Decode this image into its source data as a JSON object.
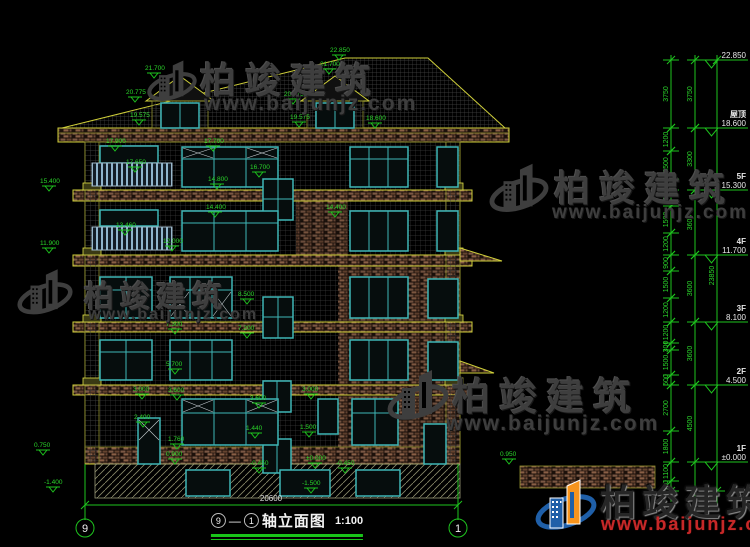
{
  "colors": {
    "cad_green": "#2ad42a",
    "cad_yellow": "#cfcf3a",
    "cad_teal": "#3fb6b6",
    "watermark_gray": "#3e3e3e",
    "logo_blue": "#1f5fa8",
    "logo_orange": "#f7941d",
    "url_red": "#c62828",
    "level_text": "#e8e8e8"
  },
  "watermark": {
    "brand": "柏竣建筑",
    "url": "www.baijunjz.com"
  },
  "footer_logo": {
    "brand": "柏竣建筑",
    "url": "www.baijunjz.com"
  },
  "title": {
    "left_bubble": "9",
    "separator": "—",
    "right_bubble": "1",
    "name": "轴立面图",
    "scale": "1:100"
  },
  "bottom": {
    "total_width": "20600",
    "left_bubble": "9",
    "right_bubble": "1"
  },
  "elevation_levels": [
    {
      "label": "",
      "value": "22.850",
      "y": 60
    },
    {
      "label": "屋顶",
      "value": "18.600",
      "y": 128
    },
    {
      "label": "5F",
      "value": "15.300",
      "y": 190
    },
    {
      "label": "4F",
      "value": "11.700",
      "y": 255
    },
    {
      "label": "3F",
      "value": "8.100",
      "y": 322
    },
    {
      "label": "2F",
      "value": "4.500",
      "y": 385
    },
    {
      "label": "1F",
      "value": "±0.000",
      "y": 462
    }
  ],
  "dim_columns": [
    {
      "x": 671,
      "segments": [
        {
          "v": "3750",
          "y1": 60,
          "y2": 128
        },
        {
          "v": "1200",
          "y1": 128,
          "y2": 151
        },
        {
          "v": "1500",
          "y1": 151,
          "y2": 179
        },
        {
          "v": "600",
          "y1": 179,
          "y2": 190
        },
        {
          "v": "900",
          "y1": 190,
          "y2": 206
        },
        {
          "v": "1500",
          "y1": 206,
          "y2": 233
        },
        {
          "v": "1200",
          "y1": 233,
          "y2": 255
        },
        {
          "v": "900",
          "y1": 255,
          "y2": 271
        },
        {
          "v": "1500",
          "y1": 271,
          "y2": 298
        },
        {
          "v": "1200",
          "y1": 298,
          "y2": 322
        },
        {
          "v": "1200",
          "y1": 322,
          "y2": 343
        },
        {
          "v": "300",
          "y1": 343,
          "y2": 350
        },
        {
          "v": "1500",
          "y1": 350,
          "y2": 375
        },
        {
          "v": "600",
          "y1": 375,
          "y2": 385
        },
        {
          "v": "2700",
          "y1": 385,
          "y2": 431
        },
        {
          "v": "1800",
          "y1": 431,
          "y2": 462
        },
        {
          "v": "1100",
          "y1": 462,
          "y2": 481
        },
        {
          "v": "600",
          "y1": 481,
          "y2": 491
        }
      ]
    },
    {
      "x": 695,
      "segments": [
        {
          "v": "3750",
          "y1": 60,
          "y2": 128
        },
        {
          "v": "3300",
          "y1": 128,
          "y2": 190
        },
        {
          "v": "3600",
          "y1": 190,
          "y2": 255
        },
        {
          "v": "3600",
          "y1": 255,
          "y2": 322
        },
        {
          "v": "3600",
          "y1": 322,
          "y2": 385
        },
        {
          "v": "4500",
          "y1": 385,
          "y2": 462
        }
      ]
    },
    {
      "x": 717,
      "segments": [
        {
          "v": "23850",
          "y1": 60,
          "y2": 491
        }
      ]
    }
  ],
  "annotations": [
    {
      "t": "22.850",
      "x": 330,
      "y": 52
    },
    {
      "t": "21.700",
      "x": 145,
      "y": 70
    },
    {
      "t": "20.775",
      "x": 126,
      "y": 94
    },
    {
      "t": "19.575",
      "x": 130,
      "y": 117
    },
    {
      "t": "21.700",
      "x": 320,
      "y": 66
    },
    {
      "t": "20.775",
      "x": 284,
      "y": 96
    },
    {
      "t": "19.575",
      "x": 290,
      "y": 119
    },
    {
      "t": "18.600",
      "x": 366,
      "y": 120
    },
    {
      "t": "17.900",
      "x": 106,
      "y": 143
    },
    {
      "t": "17.700",
      "x": 204,
      "y": 143
    },
    {
      "t": "17.650",
      "x": 126,
      "y": 164
    },
    {
      "t": "16.700",
      "x": 250,
      "y": 169
    },
    {
      "t": "15.400",
      "x": 40,
      "y": 183
    },
    {
      "t": "14.800",
      "x": 208,
      "y": 181
    },
    {
      "t": "14.400",
      "x": 206,
      "y": 209
    },
    {
      "t": "14.400",
      "x": 326,
      "y": 209
    },
    {
      "t": "13.460",
      "x": 116,
      "y": 227
    },
    {
      "t": "12.000",
      "x": 163,
      "y": 243
    },
    {
      "t": "11.900",
      "x": 40,
      "y": 245
    },
    {
      "t": "8.500",
      "x": 238,
      "y": 296
    },
    {
      "t": "7.300",
      "x": 166,
      "y": 326
    },
    {
      "t": "7.200",
      "x": 238,
      "y": 330
    },
    {
      "t": "5.700",
      "x": 166,
      "y": 366
    },
    {
      "t": "3.600",
      "x": 168,
      "y": 392
    },
    {
      "t": "3.000",
      "x": 133,
      "y": 391
    },
    {
      "t": "2.400",
      "x": 134,
      "y": 419
    },
    {
      "t": "1.760",
      "x": 168,
      "y": 441
    },
    {
      "t": "3.600",
      "x": 250,
      "y": 400
    },
    {
      "t": "1.440",
      "x": 246,
      "y": 430
    },
    {
      "t": "-0.450",
      "x": 250,
      "y": 465
    },
    {
      "t": "3.000",
      "x": 302,
      "y": 391
    },
    {
      "t": "1.500",
      "x": 300,
      "y": 429
    },
    {
      "t": "±0.000",
      "x": 306,
      "y": 460
    },
    {
      "t": "-1.500",
      "x": 302,
      "y": 485
    },
    {
      "t": "0.900",
      "x": 166,
      "y": 456
    },
    {
      "t": "0.750",
      "x": 34,
      "y": 447
    },
    {
      "t": "-1.400",
      "x": 44,
      "y": 484
    },
    {
      "t": "-0.450",
      "x": 336,
      "y": 465
    },
    {
      "t": "0.950",
      "x": 500,
      "y": 456
    }
  ]
}
